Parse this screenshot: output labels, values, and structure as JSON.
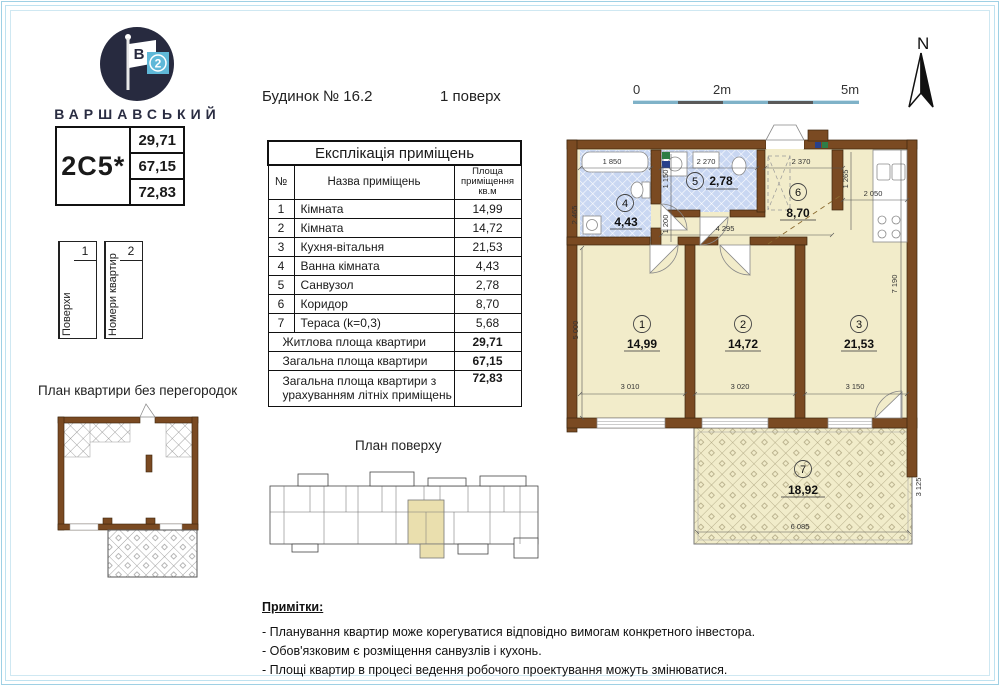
{
  "brand": {
    "name": "ВАРШАВСЬКИЙ",
    "flag_letter": "В",
    "flag_number": "2"
  },
  "unit": {
    "code": "2C5*",
    "living_area": "29,71",
    "total_area": "67,15",
    "total_with_summer": "72,83"
  },
  "floors": {
    "label": "Поверхи",
    "value": "1"
  },
  "apartments": {
    "label": "Номери квартир",
    "value": "2"
  },
  "header": {
    "building": "Будинок № 16.2",
    "floor": "1 поверх"
  },
  "scalebar": {
    "l0": "0",
    "l2": "2m",
    "l5": "5m"
  },
  "compass": {
    "north": "N"
  },
  "plans": {
    "no_partitions_title": "План квартири без перегородок",
    "floor_plan_title": "План поверху"
  },
  "explication": {
    "title": "Експлікація приміщень",
    "col_num": "№",
    "col_name": "Назва приміщень",
    "col_area": "Площа приміщення кв.м",
    "rows": [
      {
        "n": "1",
        "name": "Кімната",
        "area": "14,99"
      },
      {
        "n": "2",
        "name": "Кімната",
        "area": "14,72"
      },
      {
        "n": "3",
        "name": "Кухня-вітальня",
        "area": "21,53"
      },
      {
        "n": "4",
        "name": "Ванна кімната",
        "area": "4,43"
      },
      {
        "n": "5",
        "name": "Санвузол",
        "area": "2,78"
      },
      {
        "n": "6",
        "name": "Коридор",
        "area": "8,70"
      },
      {
        "n": "7",
        "name": "Тераса (k=0,3)",
        "area": "5,68"
      }
    ],
    "summary": [
      {
        "label": "Житлова площа квартири",
        "value": "29,71"
      },
      {
        "label": "Загальна площа квартири",
        "value": "67,15"
      },
      {
        "label": "Загальна площа квартири з урахуванням літніх приміщень",
        "value": "72,83"
      }
    ]
  },
  "plan": {
    "rooms": [
      {
        "num": "1",
        "area": "14,99"
      },
      {
        "num": "2",
        "area": "14,72"
      },
      {
        "num": "3",
        "area": "21,53"
      },
      {
        "num": "4",
        "area": "4,43"
      },
      {
        "num": "5",
        "area": "2,78"
      },
      {
        "num": "6",
        "area": "8,70"
      },
      {
        "num": "7",
        "area": "18,92"
      }
    ],
    "dims": {
      "bath_w": "1 850",
      "bath_h": "2 465",
      "wc_w": "2 270",
      "wc_h": "1 150",
      "hall_v": "1 200",
      "hall_w": "2 370",
      "hall_h": "1 265",
      "kitchen_w": "2 050",
      "corridor_w": "4 295",
      "room1_h": "5 000",
      "room1_w": "3 010",
      "room2_w": "3 020",
      "room3_w": "3 150",
      "room3_h": "7 190",
      "terrace_w": "6 085",
      "terrace_h": "3 125"
    }
  },
  "notes": {
    "title": "Примітки:",
    "items": [
      "- Планування квартир може корегуватися відповідно вимогам конкретного інвестора.",
      "- Обов'язковим є розміщення санвузлів і кухонь.",
      "- Площі квартир в процесі ведення робочого проектування можуть змінюватися."
    ]
  }
}
